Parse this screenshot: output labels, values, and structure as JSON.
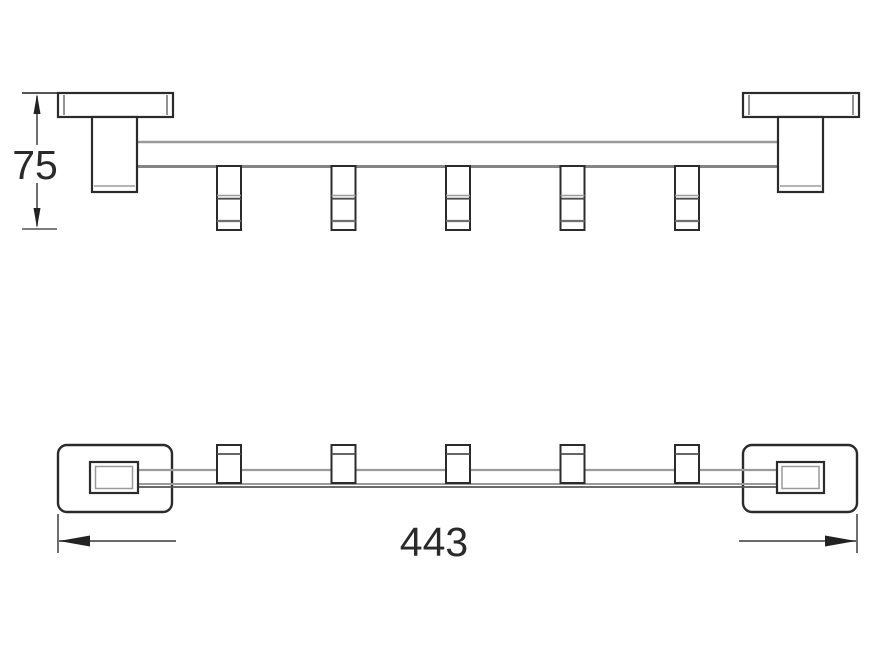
{
  "drawing": {
    "front_view": {
      "height_dimension_label": "75",
      "hook_count": 5
    },
    "bottom_view": {
      "width_dimension_label": "443",
      "hook_count": 5
    },
    "colors": {
      "background": "#ffffff",
      "outline": "#2b2b2b",
      "bar_line": "#9a9a9a",
      "bar_line_dark": "#808080",
      "dimension_line": "#3d3d3d",
      "label_text": "#2a2a2a"
    }
  }
}
